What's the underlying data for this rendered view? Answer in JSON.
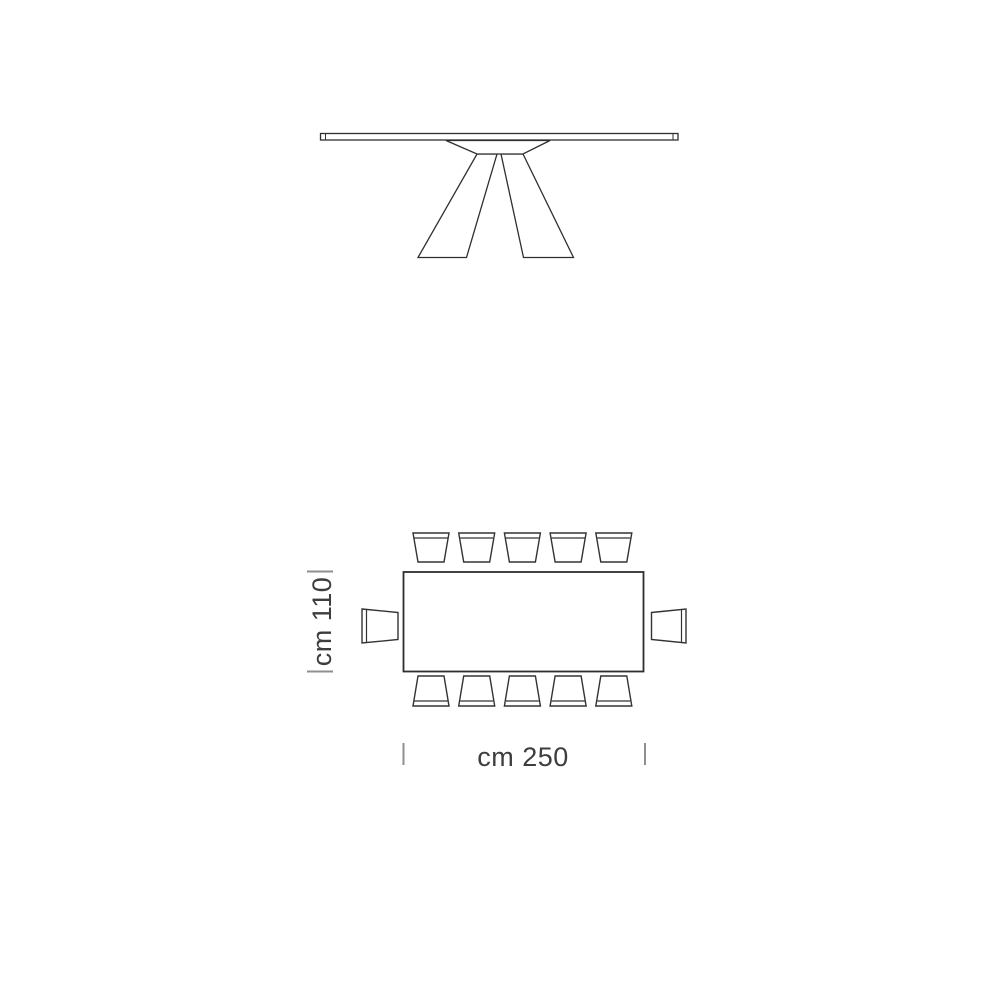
{
  "page": {
    "background_color": "#ffffff"
  },
  "diagram": {
    "type": "furniture-dimension-drawing",
    "line_color": "#2f2f2f",
    "tick_color": "#8f8f8f",
    "text_color": "#3d3d3d",
    "views": {
      "front_view": {
        "description": "table front elevation with thin top and two splayed pedestal legs"
      },
      "plan_view": {
        "description": "rectangular table top view with seating",
        "chairs_top": 5,
        "chairs_bottom": 5,
        "chairs_left": 1,
        "chairs_right": 1,
        "total_seats": 12
      }
    },
    "dimensions": {
      "depth_label": "cm 110",
      "width_label": "cm 250"
    }
  }
}
